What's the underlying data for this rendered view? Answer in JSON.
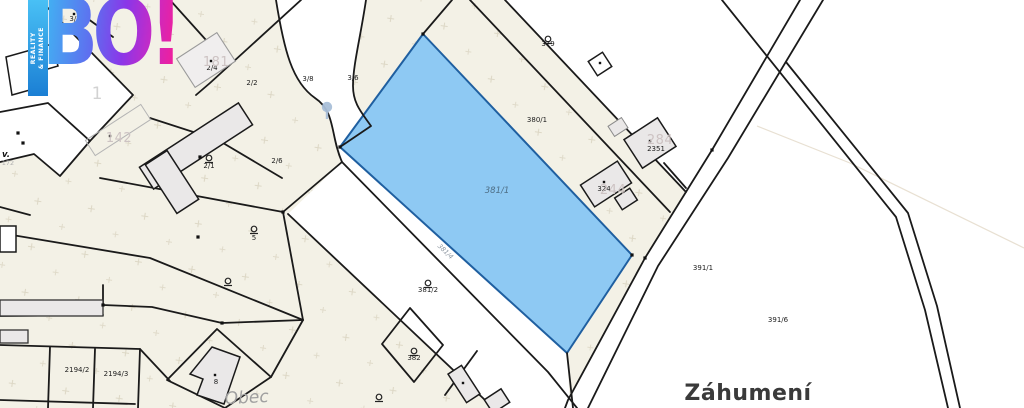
{
  "branding": {
    "logo_text": "BO!",
    "tagline_line1": "REALITY",
    "tagline_line2": "& FINANCE",
    "gradient_start": "#41b2f2",
    "gradient_end": "#f01f9c"
  },
  "map": {
    "highlighted_parcel": "381/1",
    "colors": {
      "highlight_fill": "#8ec9f3",
      "highlight_stroke": "#1f5fa0",
      "parcel_fill_beige": "#f3f1e6",
      "line": "#1a1a1a",
      "building_fill": "#eae8e8",
      "pin": "#a9bfd9"
    },
    "parcel_labels": [
      {
        "text": "3/1",
        "x": 75,
        "y": 21,
        "kind": "p"
      },
      {
        "text": "2/4",
        "x": 212,
        "y": 70,
        "kind": "p"
      },
      {
        "text": "2/2",
        "x": 252,
        "y": 85,
        "kind": "p"
      },
      {
        "text": "3/8",
        "x": 308,
        "y": 81,
        "kind": "p"
      },
      {
        "text": "3/6",
        "x": 353,
        "y": 80,
        "kind": "p"
      },
      {
        "text": "2/1",
        "x": 209,
        "y": 168,
        "kind": "p"
      },
      {
        "text": "2/6",
        "x": 277,
        "y": 163,
        "kind": "p"
      },
      {
        "text": "5",
        "x": 254,
        "y": 240,
        "kind": "p"
      },
      {
        "text": "379",
        "x": 548,
        "y": 46,
        "kind": "p"
      },
      {
        "text": "380/1",
        "x": 537,
        "y": 122,
        "kind": "p"
      },
      {
        "text": "2351",
        "x": 656,
        "y": 151,
        "kind": "p"
      },
      {
        "text": "324",
        "x": 604,
        "y": 191,
        "kind": "p"
      },
      {
        "text": "391/1",
        "x": 703,
        "y": 270,
        "kind": "p"
      },
      {
        "text": "391/6",
        "x": 778,
        "y": 322,
        "kind": "p"
      },
      {
        "text": "382",
        "x": 414,
        "y": 360,
        "kind": "p"
      },
      {
        "text": "381/2",
        "x": 428,
        "y": 292,
        "kind": "p"
      },
      {
        "text": "2194/2",
        "x": 77,
        "y": 372,
        "kind": "p"
      },
      {
        "text": "2194/3",
        "x": 116,
        "y": 376,
        "kind": "p"
      },
      {
        "text": "8",
        "x": 216,
        "y": 384,
        "kind": "p"
      },
      {
        "text": "381/1",
        "x": 497,
        "y": 193,
        "kind": "ph"
      },
      {
        "text": "381/4",
        "x": 444,
        "y": 253,
        "kind": "pr",
        "rot": 44
      },
      {
        "text": "172",
        "x": 8,
        "y": 165,
        "kind": "gs"
      },
      {
        "text": "v.",
        "x": 6,
        "y": 157,
        "kind": "sv"
      }
    ],
    "house_numbers": [
      {
        "text": "181",
        "x": 216,
        "y": 66,
        "kind": "g"
      },
      {
        "text": "142",
        "x": 119,
        "y": 142,
        "kind": "g"
      },
      {
        "text": "244",
        "x": 613,
        "y": 194,
        "kind": "g"
      },
      {
        "text": "284",
        "x": 660,
        "y": 144,
        "kind": "g"
      },
      {
        "text": "1",
        "x": 97,
        "y": 99,
        "kind": "gb"
      }
    ],
    "place_labels": [
      {
        "text": "Obec",
        "x": 247,
        "y": 403,
        "kind": "obec",
        "rot": -3
      },
      {
        "text": "Záhumení",
        "x": 748,
        "y": 400,
        "kind": "street"
      }
    ],
    "garden_symbols": [
      {
        "x": 209,
        "y": 158
      },
      {
        "x": 254,
        "y": 229
      },
      {
        "x": 228,
        "y": 281
      },
      {
        "x": 548,
        "y": 39
      },
      {
        "x": 414,
        "y": 351
      },
      {
        "x": 379,
        "y": 397
      },
      {
        "x": 428,
        "y": 283
      }
    ],
    "pin": {
      "x": 327,
      "y": 107
    },
    "survey_points": [
      {
        "x": 423,
        "y": 34
      },
      {
        "x": 340,
        "y": 147
      },
      {
        "x": 632,
        "y": 255
      },
      {
        "x": 283,
        "y": 212
      },
      {
        "x": 222,
        "y": 323
      },
      {
        "x": 18,
        "y": 133
      },
      {
        "x": 23,
        "y": 143
      },
      {
        "x": 200,
        "y": 157
      },
      {
        "x": 198,
        "y": 237
      },
      {
        "x": 712,
        "y": 150
      },
      {
        "x": 645,
        "y": 258
      },
      {
        "x": 103,
        "y": 305
      }
    ],
    "building_points": [
      {
        "x": 600,
        "y": 63
      },
      {
        "x": 650,
        "y": 141
      },
      {
        "x": 604,
        "y": 182
      },
      {
        "x": 215,
        "y": 375
      },
      {
        "x": 463,
        "y": 383
      },
      {
        "x": 211,
        "y": 61
      },
      {
        "x": 110,
        "y": 136
      },
      {
        "x": 74,
        "y": 14
      }
    ]
  }
}
